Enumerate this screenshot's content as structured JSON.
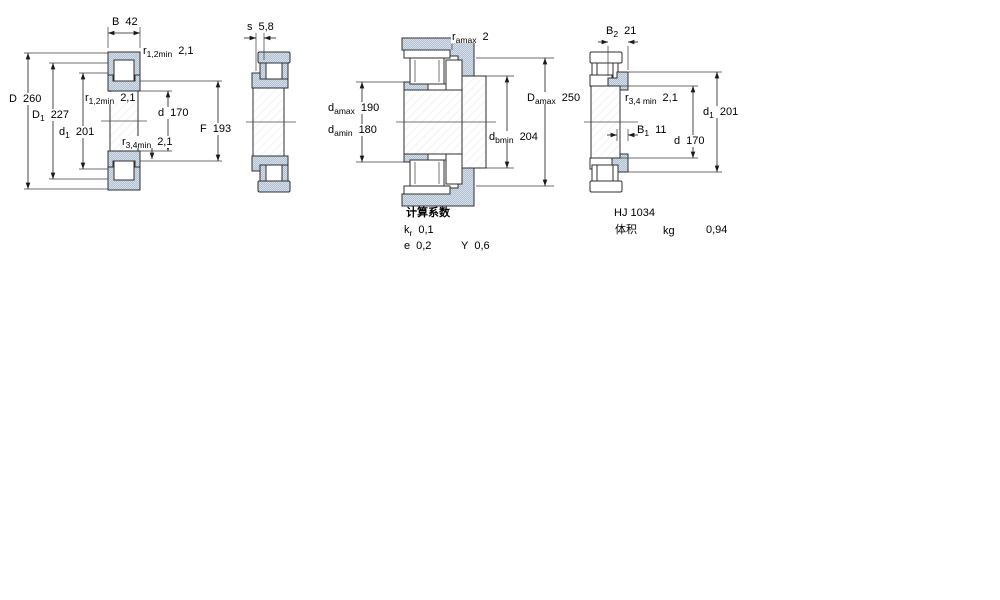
{
  "v1": {
    "B": {
      "sym": "B",
      "sub": "",
      "val": "42"
    },
    "r12_top": {
      "sym": "r",
      "sub": "1,2min",
      "val": "2,1"
    },
    "D": {
      "sym": "D",
      "sub": "",
      "val": "260"
    },
    "D1": {
      "sym": "D",
      "sub": "1",
      "val": "227"
    },
    "d1": {
      "sym": "d",
      "sub": "1",
      "val": "201"
    },
    "r12_mid": {
      "sym": "r",
      "sub": "1,2min",
      "val": "2,1"
    },
    "d": {
      "sym": "d",
      "sub": "",
      "val": "170"
    },
    "r34": {
      "sym": "r",
      "sub": "3,4min",
      "val": "2,1"
    },
    "F": {
      "sym": "F",
      "sub": "",
      "val": "193"
    }
  },
  "v2": {
    "s": {
      "sym": "s",
      "sub": "",
      "val": "5,8"
    }
  },
  "v3": {
    "ra": {
      "sym": "r",
      "sub": "amax",
      "val": "2"
    },
    "damax": {
      "sym": "d",
      "sub": "amax",
      "val": "190"
    },
    "damin": {
      "sym": "d",
      "sub": "amin",
      "val": "180"
    },
    "dbmin": {
      "sym": "d",
      "sub": "bmin",
      "val": "204"
    },
    "Damax": {
      "sym": "D",
      "sub": "amax",
      "val": "250"
    }
  },
  "v4": {
    "B2": {
      "sym": "B",
      "sub": "2",
      "val": "21"
    },
    "r34": {
      "sym": "r",
      "sub": "3,4 min",
      "val": "2,1"
    },
    "B1": {
      "sym": "B",
      "sub": "1",
      "val": "11"
    },
    "d1": {
      "sym": "d",
      "sub": "1",
      "val": "201"
    },
    "d": {
      "sym": "d",
      "sub": "",
      "val": "170"
    }
  },
  "factors": {
    "title": "计算系数",
    "kr": {
      "sym": "k",
      "sub": "r",
      "val": "0,1"
    },
    "e": {
      "sym": "e",
      "sub": "",
      "val": "0,2"
    },
    "y": {
      "sym": "Y",
      "sub": "",
      "val": "0,6"
    }
  },
  "product": {
    "designation": "HJ 1034",
    "mass_label": "体积",
    "mass_unit": "kg",
    "mass_value": "0,94"
  },
  "colors": {
    "ring_fill": "#aec6de",
    "outline": "#2f2f2f"
  }
}
